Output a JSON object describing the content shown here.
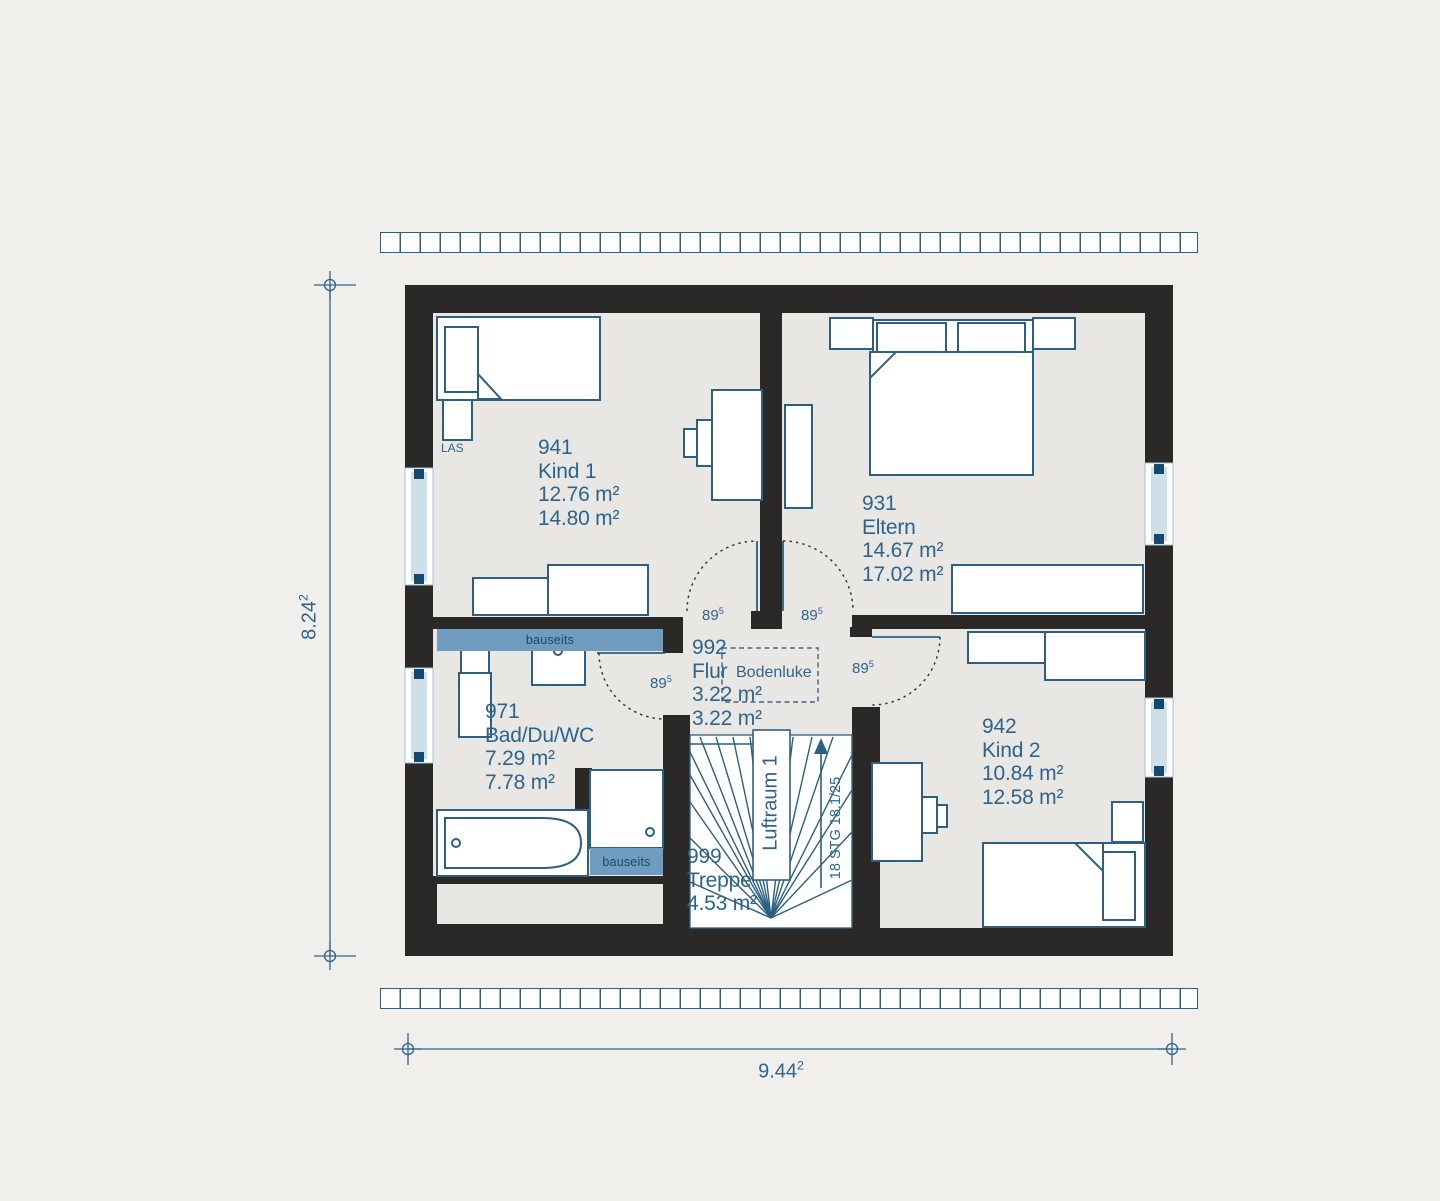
{
  "rooms": {
    "kind1": {
      "number": "941",
      "name": "Kind 1",
      "area1": "12.76 m²",
      "area2": "14.80 m²"
    },
    "eltern": {
      "number": "931",
      "name": "Eltern",
      "area1": "14.67 m²",
      "area2": "17.02 m²"
    },
    "flur": {
      "number": "992",
      "name": "Flur",
      "area1": "3.22 m²",
      "area2": "3.22 m²"
    },
    "bad": {
      "number": "971",
      "name": "Bad/Du/WC",
      "area1": "7.29 m²",
      "area2": "7.78 m²"
    },
    "kind2": {
      "number": "942",
      "name": "Kind 2",
      "area1": "10.84 m²",
      "area2": "12.58 m²"
    },
    "treppe": {
      "number": "999",
      "name": "Treppe",
      "area1": "4.53 m²"
    }
  },
  "labels": {
    "bodenluke": "Bodenluke",
    "luftraum": "Luftraum 1",
    "stairs_spec": "18 STG 18.1/25",
    "las": "LAS",
    "bauseits": "bauseits"
  },
  "doors": {
    "width_base": "89",
    "width_sup": "5"
  },
  "dimensions": {
    "height": {
      "base": "8.24",
      "sup": "2"
    },
    "width": {
      "base": "9.44",
      "sup": "2"
    }
  },
  "colors": {
    "wall": "#2a2928",
    "floor": "#e9e7e4",
    "background": "#f0efec",
    "line_blue": "#2d5f80",
    "text_blue": "#2e648c",
    "bauseits_fill": "#6f9cbf",
    "window_pale": "#cfdfe9",
    "window_dark": "#14486e",
    "stair_white": "#ffffff"
  }
}
